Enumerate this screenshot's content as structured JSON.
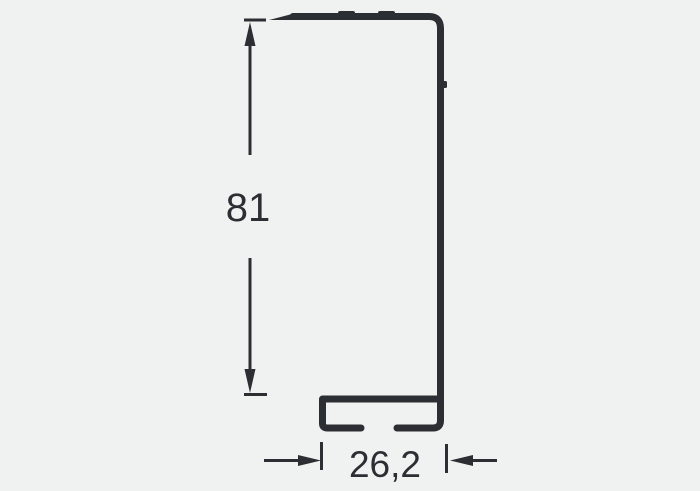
{
  "drawing": {
    "kind": "technical-profile-cross-section",
    "colors": {
      "line": "#2b2e33",
      "background": "#f0f1f1"
    },
    "height_dimension": {
      "label": "81",
      "value": 81,
      "orientation": "vertical"
    },
    "width_dimension": {
      "label": "26,2",
      "value": 26.2,
      "orientation": "horizontal"
    }
  }
}
